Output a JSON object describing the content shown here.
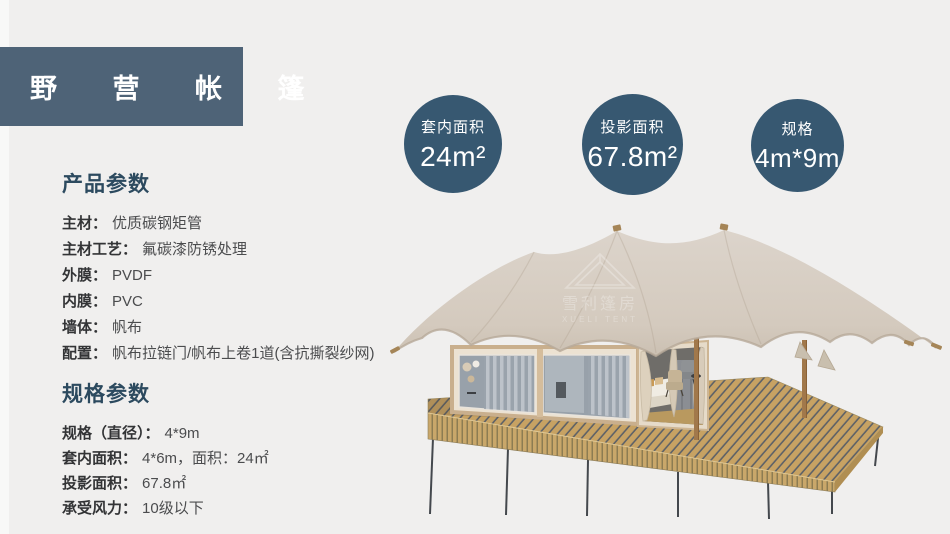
{
  "page": {
    "title": "野 营 帐 篷",
    "background": "#f0efee"
  },
  "badges": [
    {
      "label": "套内面积",
      "value": "24m²"
    },
    {
      "label": "投影面积",
      "value": "67.8m²"
    },
    {
      "label": "规格",
      "value": "4m*9m"
    }
  ],
  "product_params": {
    "heading": "产品参数",
    "items": [
      {
        "label": "主材：",
        "value": "优质碳钢矩管"
      },
      {
        "label": "主材工艺：",
        "value": "氟碳漆防锈处理"
      },
      {
        "label": "外膜：",
        "value": "PVDF"
      },
      {
        "label": "内膜：",
        "value": "PVC"
      },
      {
        "label": "墙体：",
        "value": "帆布"
      },
      {
        "label": "配置：",
        "value": "帆布拉链门/帆布上卷1道(含抗撕裂纱网)"
      }
    ]
  },
  "spec_params": {
    "heading": "规格参数",
    "items": [
      {
        "label": "规格（直径）：",
        "value": "4*9m"
      },
      {
        "label": "套内面积：",
        "value": "4*6m，面积：24㎡"
      },
      {
        "label": "投影面积：",
        "value": "67.8㎡"
      },
      {
        "label": "承受风力：",
        "value": "10级以下"
      }
    ]
  },
  "tent_image": {
    "watermark_cn": "雪利篷房",
    "watermark_en": "XUELI TENT",
    "colors": {
      "canopy": "#d8cfc5",
      "wall": "#ece2d2",
      "frame": "#c9af8d",
      "glass": "#98a1aa",
      "curtain": "#c3c9d0",
      "deck_wood": "#c7a263",
      "deck_gap": "#5d6167",
      "leg": "#44484d",
      "post": "#a1784b",
      "accent_dark": "#375871"
    }
  }
}
